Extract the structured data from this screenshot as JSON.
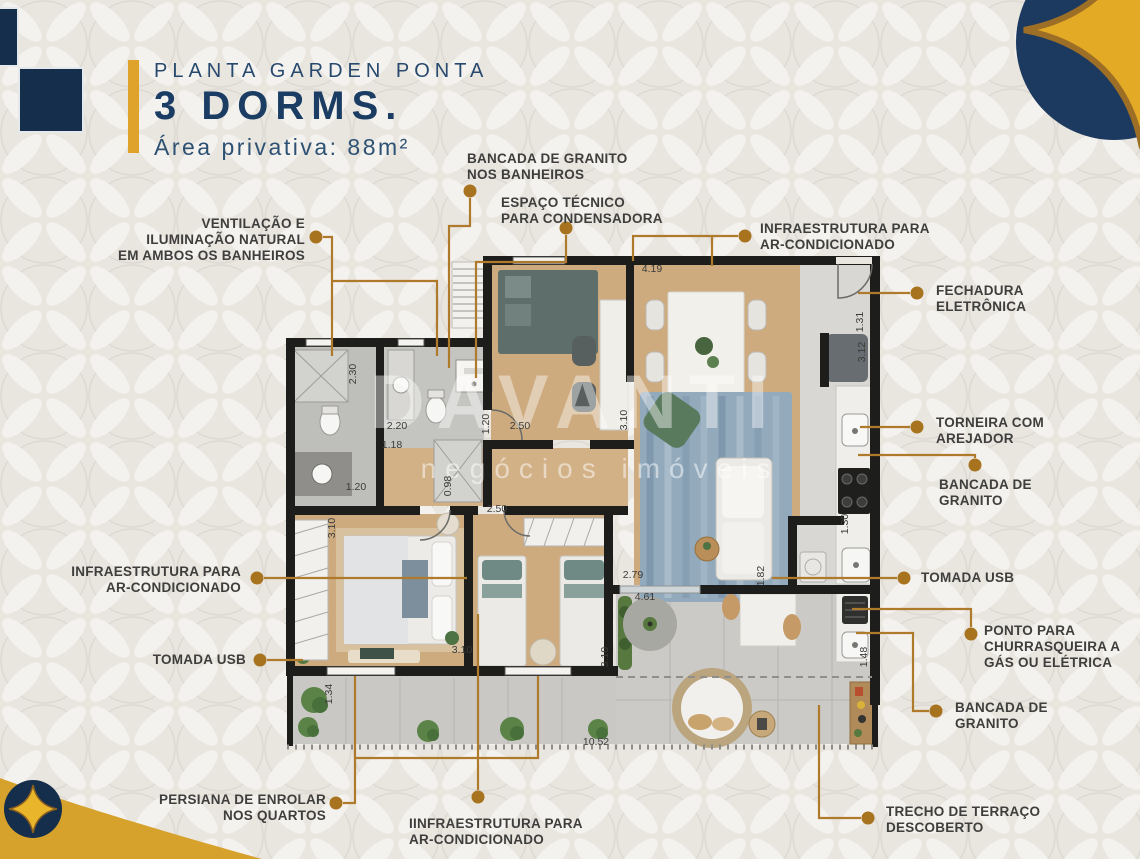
{
  "header": {
    "kicker": "PLANTA GARDEN PONTA",
    "title": "3 DORMS.",
    "subtitle": "Área privativa: 88m²"
  },
  "watermark": {
    "line1": "DAVANTI",
    "line2": "negócios imóveis"
  },
  "palette": {
    "navy": "#152e4c",
    "gold": "#dfa32b",
    "cline": "#b07a2d",
    "cdot": "#a7731e",
    "ctext": "#3e3e3d"
  },
  "callouts": [
    {
      "id": "bancada-banheiros",
      "lines": [
        "BANCADA DE GRANITO",
        "NOS BANHEIROS"
      ],
      "anchor": "left",
      "x": 467,
      "y": 151,
      "dot": [
        470,
        191
      ],
      "paths": [
        [
          [
            470,
            198
          ],
          [
            470,
            226
          ],
          [
            449,
            226
          ],
          [
            449,
            368
          ]
        ]
      ]
    },
    {
      "id": "espaco-tecnico",
      "lines": [
        "ESPAÇO TÉCNICO",
        "PARA CONDENSADORA"
      ],
      "anchor": "left",
      "x": 501,
      "y": 195,
      "dot": [
        566,
        228
      ],
      "paths": [
        [
          [
            566,
            235
          ],
          [
            566,
            262
          ],
          [
            476,
            262
          ],
          [
            476,
            378
          ]
        ]
      ]
    },
    {
      "id": "ventilacao",
      "lines": [
        "VENTILAÇÃO E",
        "ILUMINAÇÃO NATURAL",
        "EM AMBOS OS BANHEIROS"
      ],
      "anchor": "right",
      "x": 305,
      "y": 216,
      "dot": [
        316,
        237
      ],
      "paths": [
        [
          [
            323,
            237
          ],
          [
            332,
            237
          ],
          [
            332,
            356
          ]
        ],
        [
          [
            332,
            281
          ],
          [
            437,
            281
          ],
          [
            437,
            356
          ]
        ]
      ]
    },
    {
      "id": "infra-ar-topo",
      "lines": [
        "INFRAESTRUTURA PARA",
        "AR-CONDICIONADO"
      ],
      "anchor": "left",
      "x": 760,
      "y": 221,
      "dot": [
        745,
        236
      ],
      "paths": [
        [
          [
            738,
            236
          ],
          [
            633,
            236
          ],
          [
            633,
            261
          ]
        ],
        [
          [
            712,
            236
          ],
          [
            712,
            266
          ]
        ]
      ]
    },
    {
      "id": "fechadura-eletronica",
      "lines": [
        "FECHADURA",
        "ELETRÔNICA"
      ],
      "anchor": "left",
      "x": 936,
      "y": 283,
      "dot": [
        917,
        293
      ],
      "paths": [
        [
          [
            910,
            293
          ],
          [
            858,
            293
          ]
        ]
      ]
    },
    {
      "id": "torneira-arejador",
      "lines": [
        "TORNEIRA COM",
        "AREJADOR"
      ],
      "anchor": "left",
      "x": 936,
      "y": 415,
      "dot": [
        917,
        427
      ],
      "paths": [
        [
          [
            910,
            427
          ],
          [
            860,
            427
          ]
        ]
      ]
    },
    {
      "id": "bancada-cozinha",
      "lines": [
        "BANCADA DE",
        "GRANITO"
      ],
      "anchor": "left",
      "x": 939,
      "y": 477,
      "dot": [
        975,
        465
      ],
      "paths": [
        [
          [
            975,
            458
          ],
          [
            975,
            455
          ],
          [
            858,
            455
          ]
        ]
      ]
    },
    {
      "id": "tomada-usb-direita",
      "lines": [
        "TOMADA USB"
      ],
      "anchor": "left",
      "x": 921,
      "y": 570,
      "dot": [
        904,
        578
      ],
      "paths": [
        [
          [
            897,
            578
          ],
          [
            772,
            578
          ]
        ]
      ]
    },
    {
      "id": "churrasqueira",
      "lines": [
        "PONTO PARA",
        "CHURRASQUEIRA A",
        "GÁS OU ELÉTRICA"
      ],
      "anchor": "left",
      "x": 984,
      "y": 623,
      "dot": [
        971,
        634
      ],
      "paths": [
        [
          [
            971,
            627
          ],
          [
            971,
            609
          ],
          [
            852,
            609
          ]
        ]
      ]
    },
    {
      "id": "bancada-churrasqueira",
      "lines": [
        "BANCADA DE",
        "GRANITO"
      ],
      "anchor": "left",
      "x": 955,
      "y": 700,
      "dot": [
        936,
        711
      ],
      "paths": [
        [
          [
            929,
            711
          ],
          [
            913,
            711
          ],
          [
            913,
            633
          ],
          [
            856,
            633
          ]
        ]
      ]
    },
    {
      "id": "trecho-terraco",
      "lines": [
        "TRECHO DE TERRAÇO",
        "DESCOBERTO"
      ],
      "anchor": "left",
      "x": 886,
      "y": 804,
      "dot": [
        868,
        818
      ],
      "paths": [
        [
          [
            861,
            818
          ],
          [
            819,
            818
          ],
          [
            819,
            705
          ]
        ]
      ]
    },
    {
      "id": "infra-ar-esquerda",
      "lines": [
        "INFRAESTRUTURA PARA",
        "AR-CONDICIONADO"
      ],
      "anchor": "right",
      "x": 241,
      "y": 564,
      "dot": [
        257,
        578
      ],
      "paths": [
        [
          [
            264,
            578
          ],
          [
            467,
            578
          ]
        ]
      ]
    },
    {
      "id": "tomada-usb-esquerda",
      "lines": [
        "TOMADA USB"
      ],
      "anchor": "right",
      "x": 246,
      "y": 652,
      "dot": [
        260,
        660
      ],
      "paths": [
        [
          [
            267,
            660
          ],
          [
            303,
            660
          ]
        ]
      ]
    },
    {
      "id": "persiana",
      "lines": [
        "PERSIANA DE ENROLAR",
        "NOS QUARTOS"
      ],
      "anchor": "right",
      "x": 326,
      "y": 792,
      "dot": [
        336,
        803
      ],
      "paths": [
        [
          [
            343,
            803
          ],
          [
            355,
            803
          ],
          [
            355,
            676
          ]
        ],
        [
          [
            355,
            758
          ],
          [
            538,
            758
          ],
          [
            538,
            676
          ]
        ]
      ]
    },
    {
      "id": "infra-ar-quartos",
      "lines": [
        "IINFRAESTRUTURA PARA",
        "AR-CONDICIONADO"
      ],
      "anchor": "left",
      "x": 409,
      "y": 816,
      "dot": [
        478,
        797
      ],
      "paths": [
        [
          [
            478,
            790
          ],
          [
            478,
            614
          ]
        ]
      ]
    }
  ],
  "dimensions": [
    {
      "t": "4.19",
      "x": 652,
      "y": 272
    },
    {
      "t": "2.30",
      "x": 356,
      "y": 374,
      "v": true
    },
    {
      "t": "2.20",
      "x": 397,
      "y": 429
    },
    {
      "t": "1.18",
      "x": 392,
      "y": 448
    },
    {
      "t": "1.20",
      "x": 356,
      "y": 490
    },
    {
      "t": "1.20",
      "x": 489,
      "y": 424,
      "v": true
    },
    {
      "t": "2.50",
      "x": 520,
      "y": 429
    },
    {
      "t": "0.98",
      "x": 451,
      "y": 486,
      "v": true
    },
    {
      "t": "3.10",
      "x": 627,
      "y": 420,
      "v": true
    },
    {
      "t": "1.31",
      "x": 863,
      "y": 322,
      "v": true
    },
    {
      "t": "3.12",
      "x": 865,
      "y": 352,
      "v": true
    },
    {
      "t": "2.50",
      "x": 497,
      "y": 512
    },
    {
      "t": "3.10",
      "x": 335,
      "y": 528,
      "v": true
    },
    {
      "t": "3.10",
      "x": 462,
      "y": 653
    },
    {
      "t": "2.79",
      "x": 633,
      "y": 578
    },
    {
      "t": "1.82",
      "x": 764,
      "y": 576,
      "v": true
    },
    {
      "t": "4.61",
      "x": 645,
      "y": 600
    },
    {
      "t": "3.10",
      "x": 608,
      "y": 657,
      "v": true
    },
    {
      "t": "1.30",
      "x": 848,
      "y": 524,
      "v": true
    },
    {
      "t": "1.48",
      "x": 867,
      "y": 657,
      "v": true
    },
    {
      "t": "1.34",
      "x": 332,
      "y": 694,
      "v": true
    },
    {
      "t": "10.52",
      "x": 596,
      "y": 745
    }
  ]
}
